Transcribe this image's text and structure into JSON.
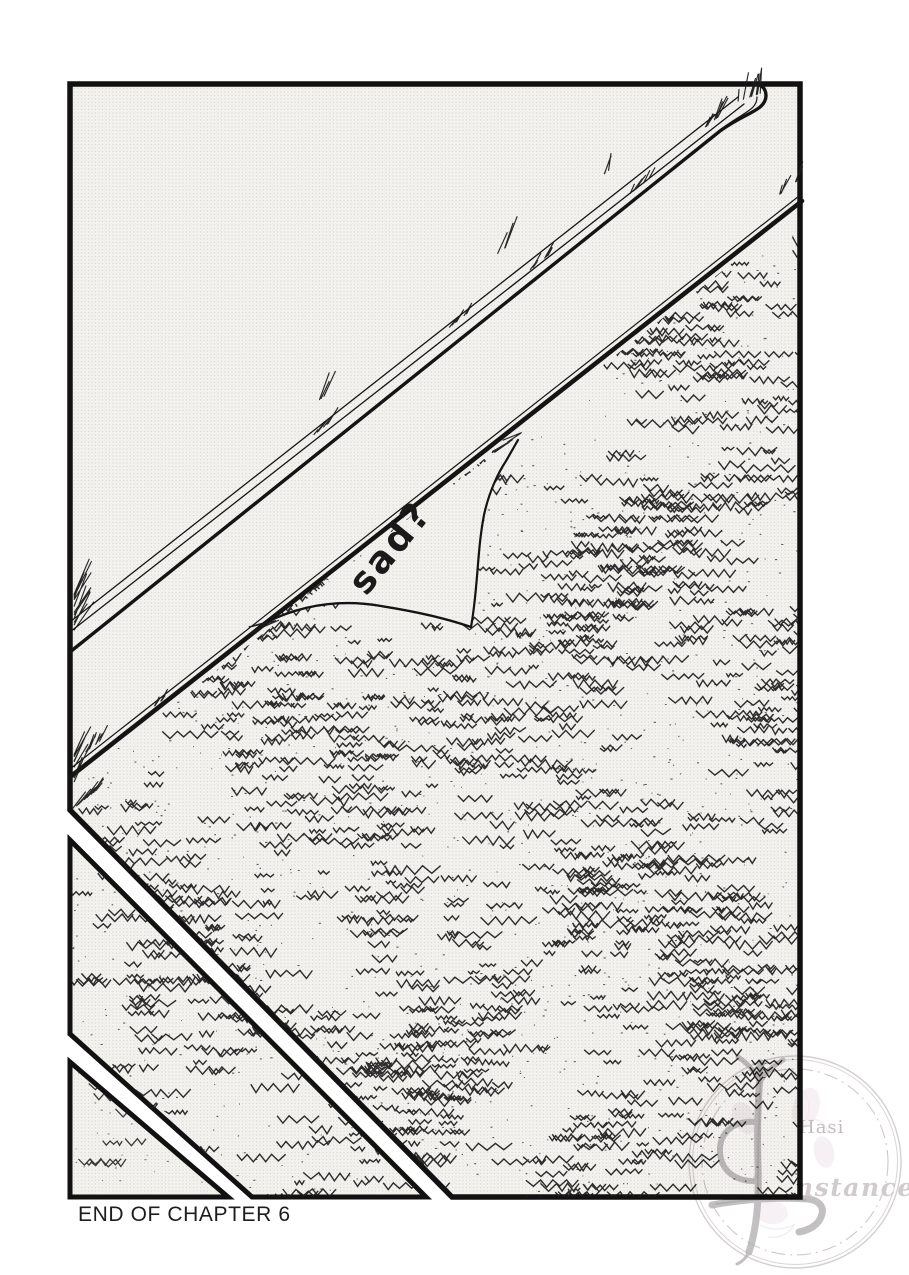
{
  "page": {
    "end_caption": "END OF CHAPTER 6",
    "background_color": "#ffffff",
    "ink_color": "#141414",
    "tone_dot_color": "#dcdad5"
  },
  "panel": {
    "speech": "sad?"
  },
  "watermark": {
    "text_top": "Hasi",
    "text_bottom": "nstance",
    "glyph": "ornate-numeral-4",
    "ring_color": "#ccc6c9",
    "text_color": "#bab4b7",
    "accent_pink": "#e3cfdd",
    "accent_green": "#a8d8bc"
  }
}
